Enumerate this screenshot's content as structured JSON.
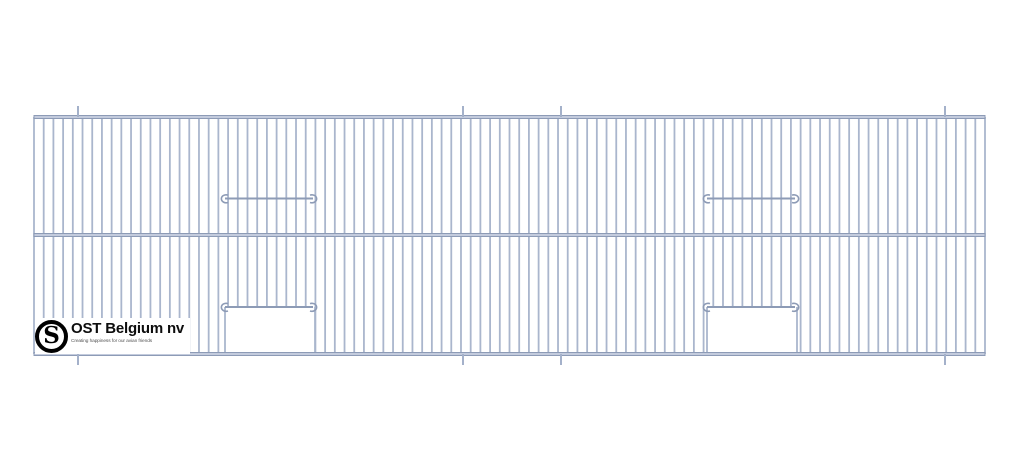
{
  "title_block": {
    "company": "OST Belgium nv",
    "tagline": "Creating happiness for our avian friends",
    "emblem_letter": "S"
  },
  "colors": {
    "background": "#ffffff",
    "wire": "#aab6cd",
    "rail_fill": "#c3cbdd",
    "rail_edge": "#8d9bb6",
    "hook": "#8d9bb6",
    "tick": "#a4b1ca",
    "logo_text": "#0d0d0d",
    "tagline_text": "#555555"
  },
  "drawing": {
    "description": "Wire mesh cage front panel with two rows, two hinged door wires on top row and two door openings with hinge wires on bottom row",
    "canvas": {
      "width": 1024,
      "height": 473
    },
    "panel": {
      "left": 34,
      "right": 985,
      "top_rail_y": 117,
      "mid_rail_y": 235,
      "bottom_rail_y": 354,
      "rail_thickness": 3,
      "wire_count": 99,
      "wire_width": 1.8
    },
    "ticks": {
      "xs": [
        78,
        463,
        561,
        945
      ],
      "length": 11,
      "width": 2
    },
    "hook_rails": [
      {
        "y": 198.5,
        "x1": 219,
        "x2": 319
      },
      {
        "y": 198.5,
        "x1": 701,
        "x2": 801
      },
      {
        "y": 307,
        "x1": 219,
        "x2": 319
      },
      {
        "y": 307,
        "x1": 701,
        "x2": 801
      }
    ],
    "door_openings": [
      {
        "x1": 225,
        "x2": 315,
        "y1": 307,
        "y2": 354
      },
      {
        "x1": 707,
        "x2": 797,
        "y1": 307,
        "y2": 354
      }
    ]
  }
}
